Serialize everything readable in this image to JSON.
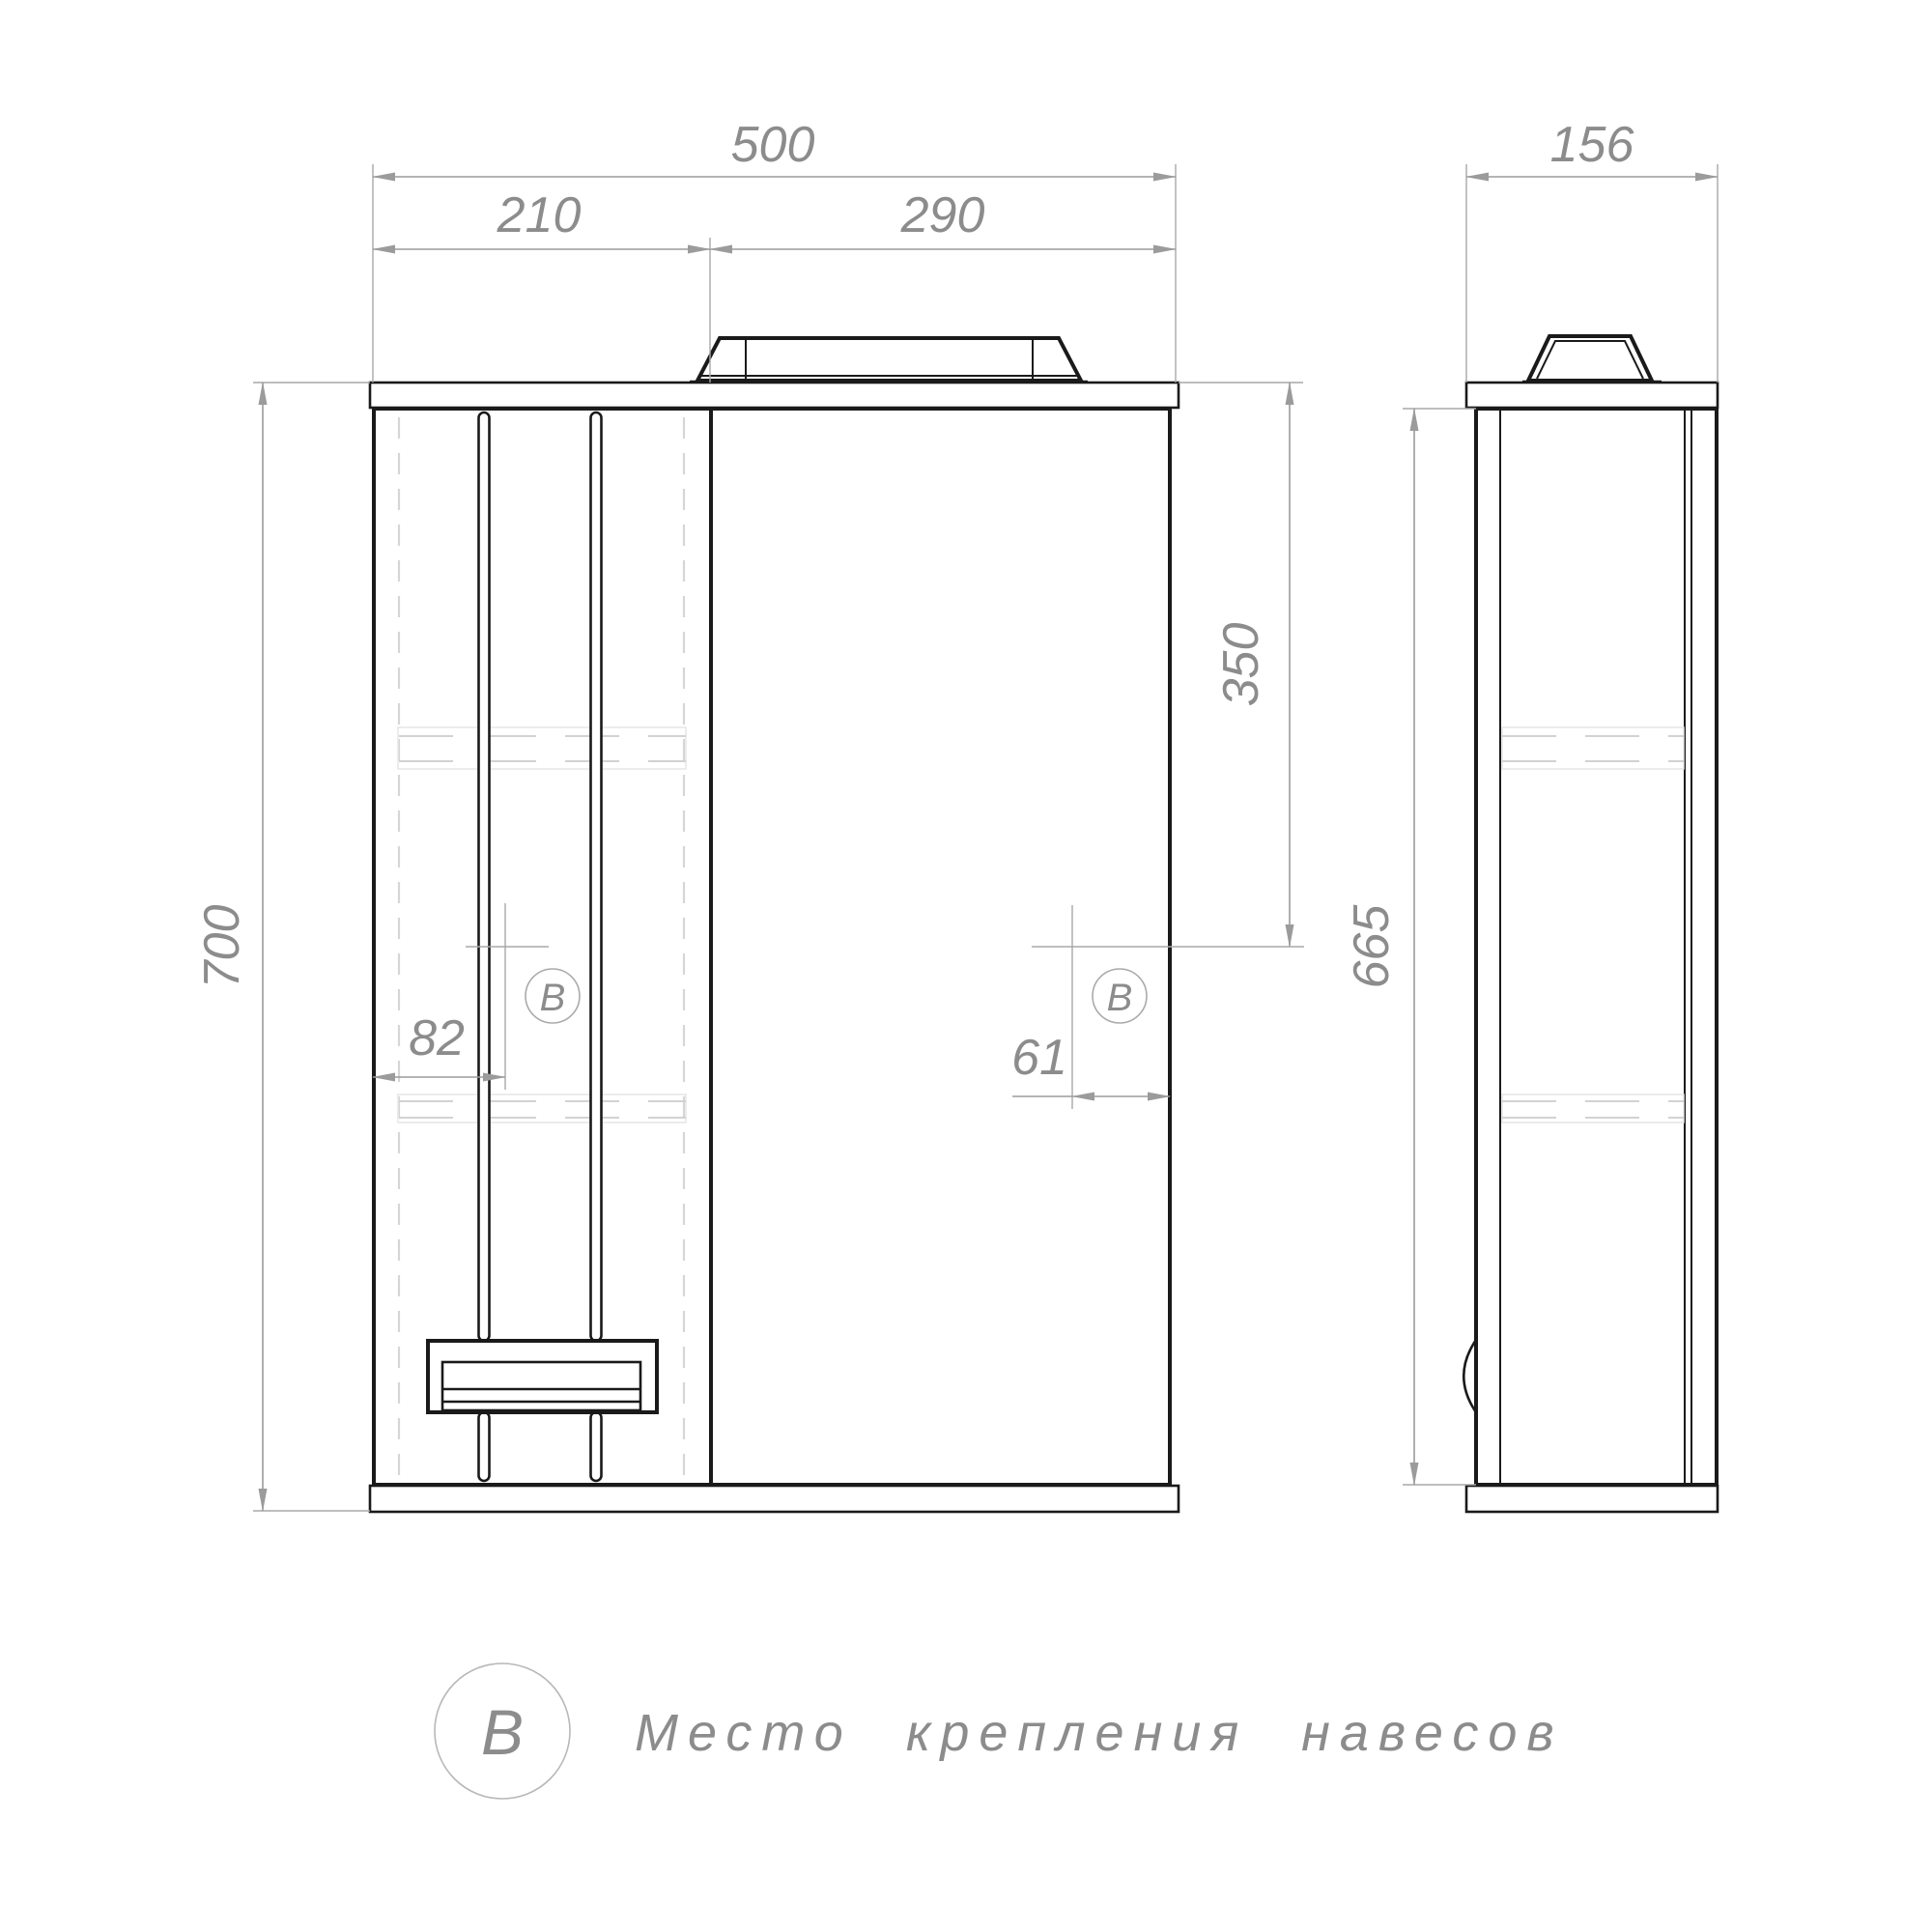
{
  "page": {
    "background": "#ffffff",
    "line_color": "#1a1a1a",
    "dim_color": "#9b9b9b",
    "label_color": "#8c8c8c"
  },
  "front_view": {
    "dims": {
      "total_width": "500",
      "left_section_width": "210",
      "right_section_width": "290",
      "total_height": "700",
      "mount_offset_left": "82",
      "mount_offset_right": "61",
      "mount_offset_top": "350"
    },
    "mount_marker": "В"
  },
  "side_view": {
    "dims": {
      "depth": "156",
      "body_height": "665"
    }
  },
  "legend": {
    "symbol": "В",
    "label": "Место крепления навесов"
  }
}
